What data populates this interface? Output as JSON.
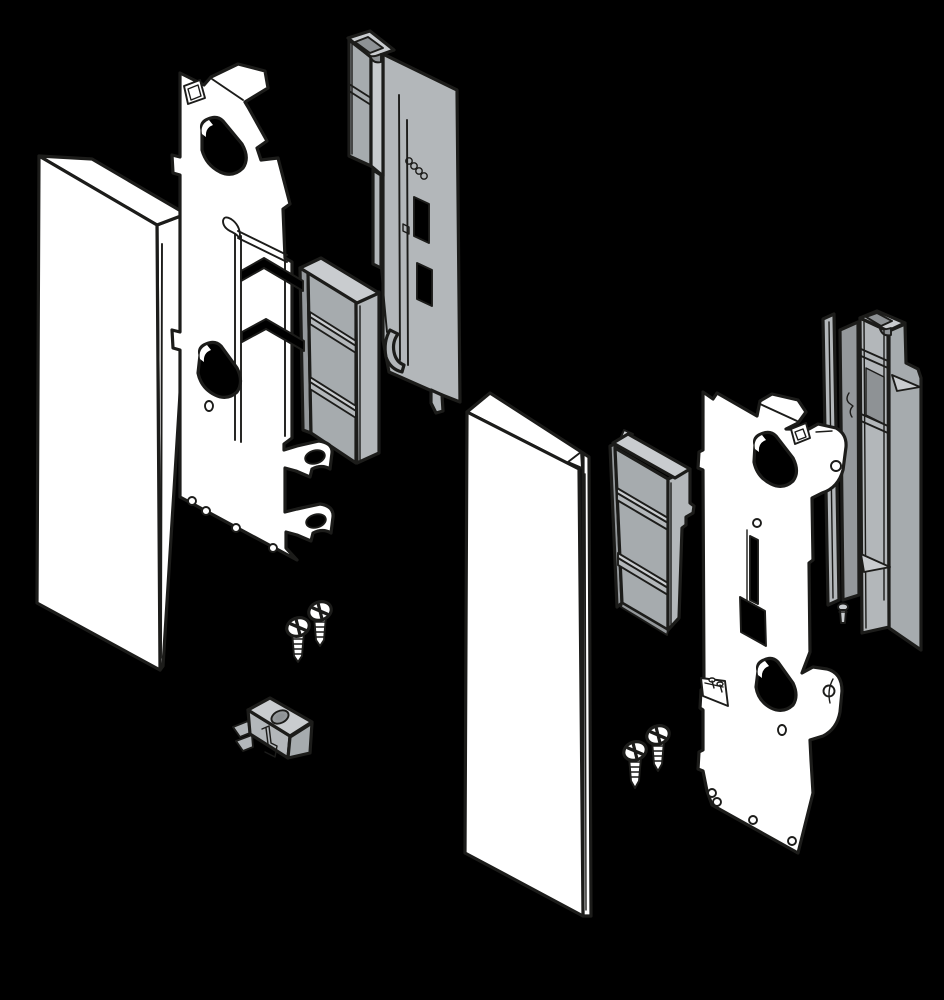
{
  "figure": {
    "title": "Exploded isometric assembly diagram of drawer front fixing brackets, left-hand and right-hand versions",
    "background": "#000000"
  },
  "palette": {
    "background": "#000000",
    "outline": "#1c1c1a",
    "part_white": "#ffffff",
    "gray_light": "#c9cccf",
    "gray_mid": "#b3b7ba",
    "gray_mid_dark": "#a6abae",
    "gray_dark": "#94989b",
    "gray_darkest": "#8e9295"
  },
  "assemblies": {
    "left": {
      "label": "Left-hand bracket assembly",
      "parts": {
        "front_panel": "Drawer front panel (left)",
        "housing": "Plastic fixing housing (left)",
        "cover_cap": "Cover cap (left)",
        "bracket_plate": "Steel front fixing bracket plate (left)",
        "screws": "Countersunk fixing screws, 2x",
        "clip": "Mounting clip adapter"
      }
    },
    "right": {
      "label": "Right-hand bracket assembly",
      "parts": {
        "front_panel": "Drawer front panel (right)",
        "cover_cap": "Cover cap (right)",
        "housing": "Plastic fixing housing (right)",
        "bracket_plate": "Steel front fixing bracket plate (right)",
        "screws": "Countersunk fixing screws, 2x"
      }
    }
  }
}
